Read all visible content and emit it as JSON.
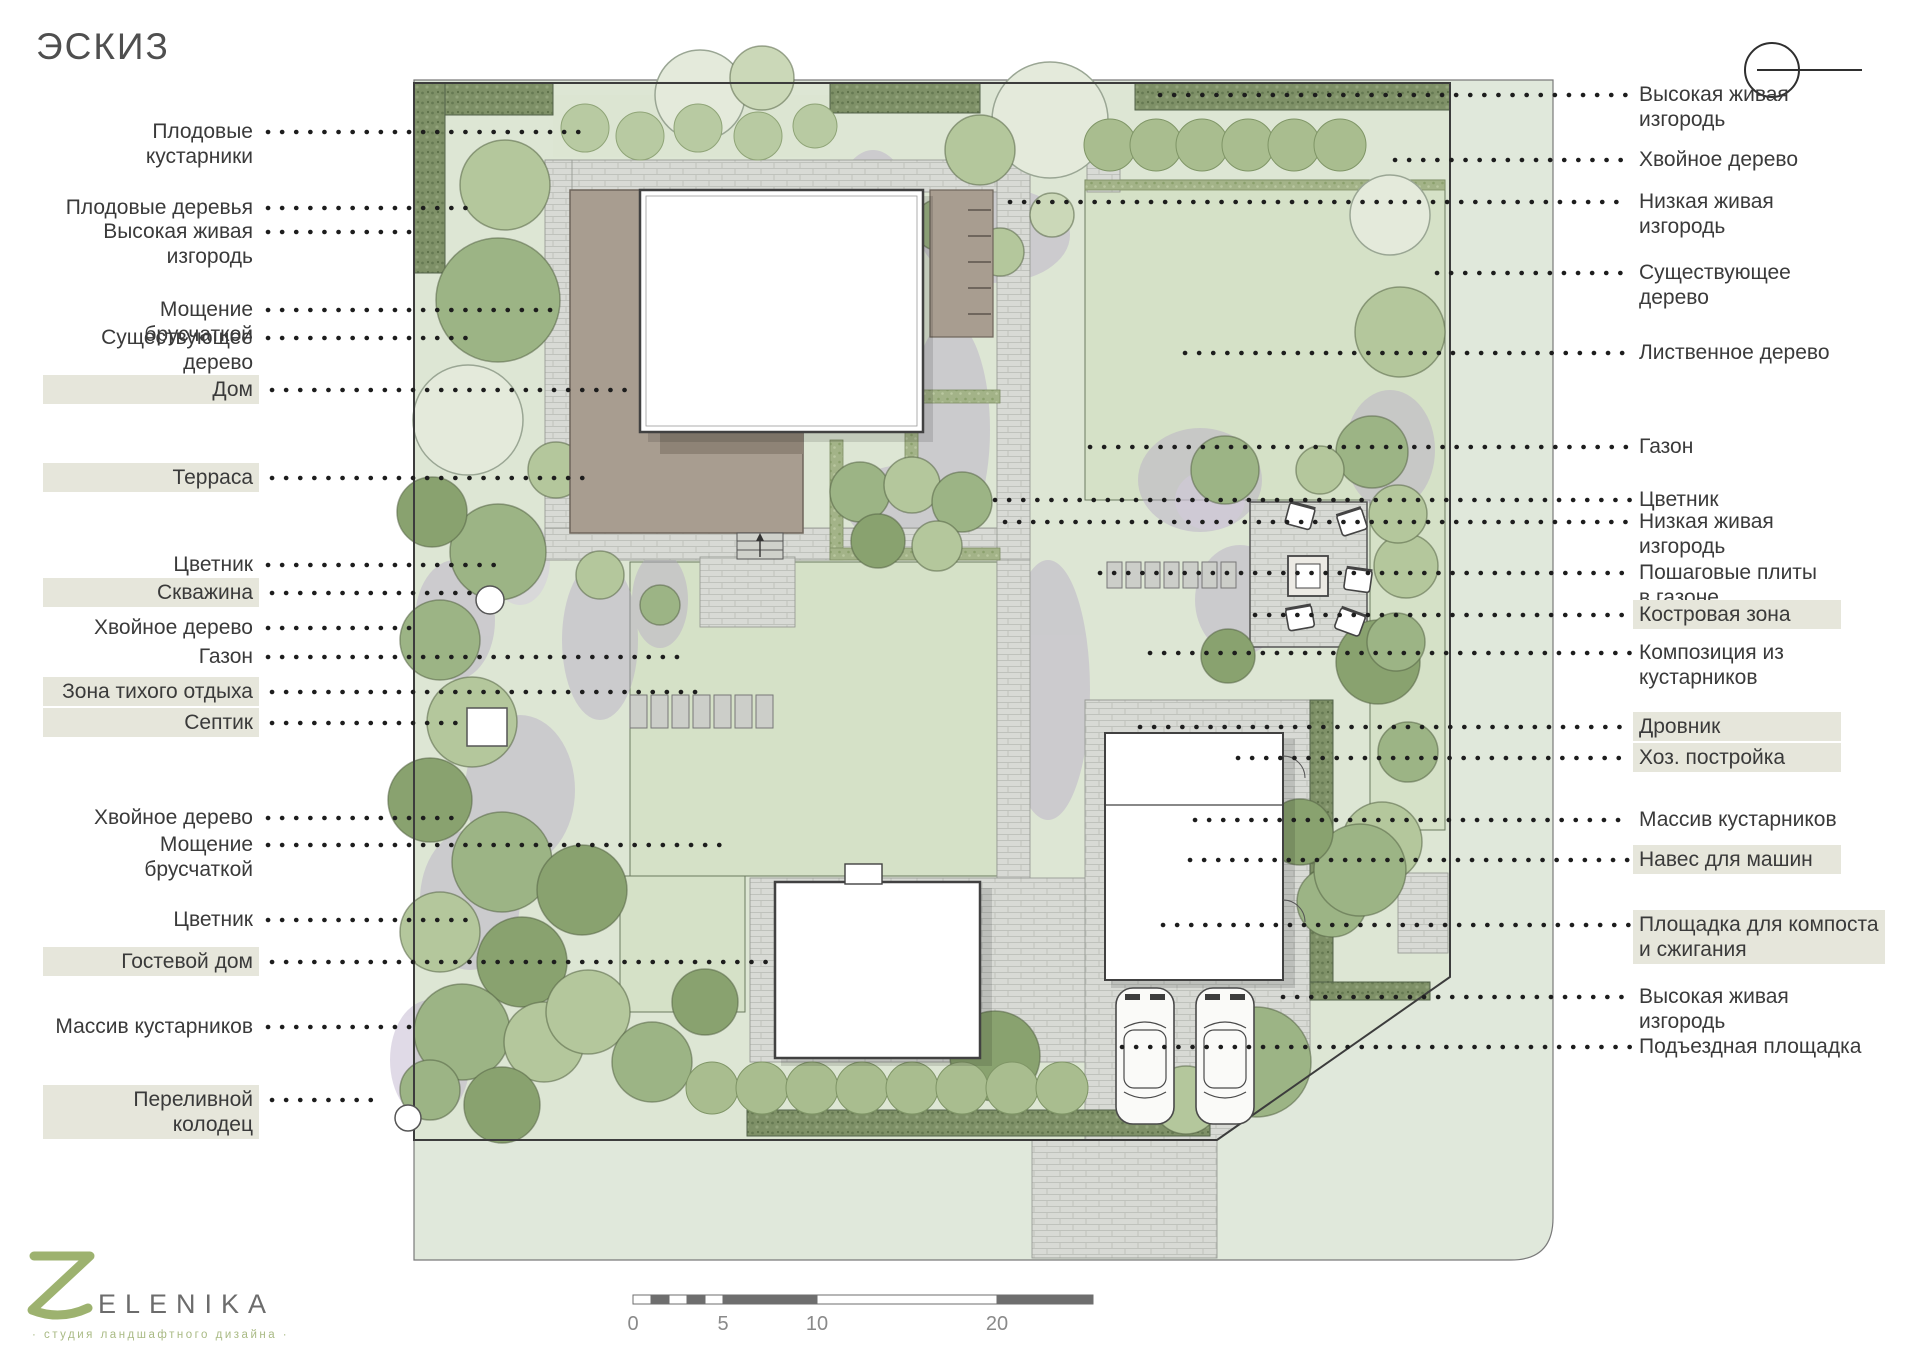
{
  "title": "ЭСКИЗ",
  "legend": {
    "left": [
      {
        "text": "Плодовые кустарники",
        "highlighted": false
      },
      {
        "text": "Плодовые деревья",
        "highlighted": false
      },
      {
        "text": "Высокая живая\nизгородь",
        "highlighted": false
      },
      {
        "text": "Мощение брусчаткой",
        "highlighted": false
      },
      {
        "text": "Существующее\nдерево",
        "highlighted": false
      },
      {
        "text": "Дом",
        "highlighted": true
      },
      {
        "text": "Терраса",
        "highlighted": true
      },
      {
        "text": "Цветник",
        "highlighted": false
      },
      {
        "text": "Скважина",
        "highlighted": true
      },
      {
        "text": "Хвойное дерево",
        "highlighted": false
      },
      {
        "text": "Газон",
        "highlighted": false
      },
      {
        "text": "Зона тихого отдыха",
        "highlighted": true
      },
      {
        "text": "Септик",
        "highlighted": true
      },
      {
        "text": "Хвойное дерево",
        "highlighted": false
      },
      {
        "text": "Мощение брусчаткой",
        "highlighted": false
      },
      {
        "text": "Цветник",
        "highlighted": false
      },
      {
        "text": "Гостевой дом",
        "highlighted": true
      },
      {
        "text": "Массив кустарников",
        "highlighted": false
      },
      {
        "text": "Переливной\nколодец",
        "highlighted": true
      }
    ],
    "right": [
      {
        "text": "Высокая живая\nизгородь",
        "highlighted": false
      },
      {
        "text": "Хвойное дерево",
        "highlighted": false
      },
      {
        "text": "Низкая живая\nизгородь",
        "highlighted": false
      },
      {
        "text": "Существующее\nдерево",
        "highlighted": false
      },
      {
        "text": "Лиственное дерево",
        "highlighted": false
      },
      {
        "text": "Газон",
        "highlighted": false
      },
      {
        "text": "Цветник",
        "highlighted": false
      },
      {
        "text": "Низкая живая\nизгородь",
        "highlighted": false
      },
      {
        "text": "Пошаговые плиты\nв газоне",
        "highlighted": false
      },
      {
        "text": "Костровая зона",
        "highlighted": true
      },
      {
        "text": "Композиция из\nкустарников",
        "highlighted": false
      },
      {
        "text": "Дровник",
        "highlighted": true
      },
      {
        "text": "Хоз. постройка",
        "highlighted": true
      },
      {
        "text": "Массив кустарников",
        "highlighted": false
      },
      {
        "text": "Навес для машин",
        "highlighted": true
      },
      {
        "text": "Площадка для компоста\nи сжигания",
        "highlighted": true
      },
      {
        "text": "Высокая живая\nизгородь",
        "highlighted": false
      },
      {
        "text": "Подъездная площадка",
        "highlighted": false
      }
    ]
  },
  "scale_bar": {
    "labels": [
      "0",
      "5",
      "10",
      "20"
    ]
  },
  "logo": {
    "name": "ELENIKA",
    "tagline": "· студия ландшафтного дизайна ·"
  },
  "icons": {
    "north": "north-indicator-icon"
  },
  "colors": {
    "street_green": "#e0e8db",
    "garden_green": "#dde6d4",
    "lawn_green": "#d5e1c7",
    "hedge_dark": "#7e9067",
    "hedge_low": "#a3b388",
    "paving_grey": "#d8dad5",
    "terrace_taupe": "#a89d90",
    "flower_purple": "#b4a6c5",
    "highlight_box": "#e6e6db",
    "logo_green": "#9db26f",
    "label_text": "#3a3a3a"
  }
}
